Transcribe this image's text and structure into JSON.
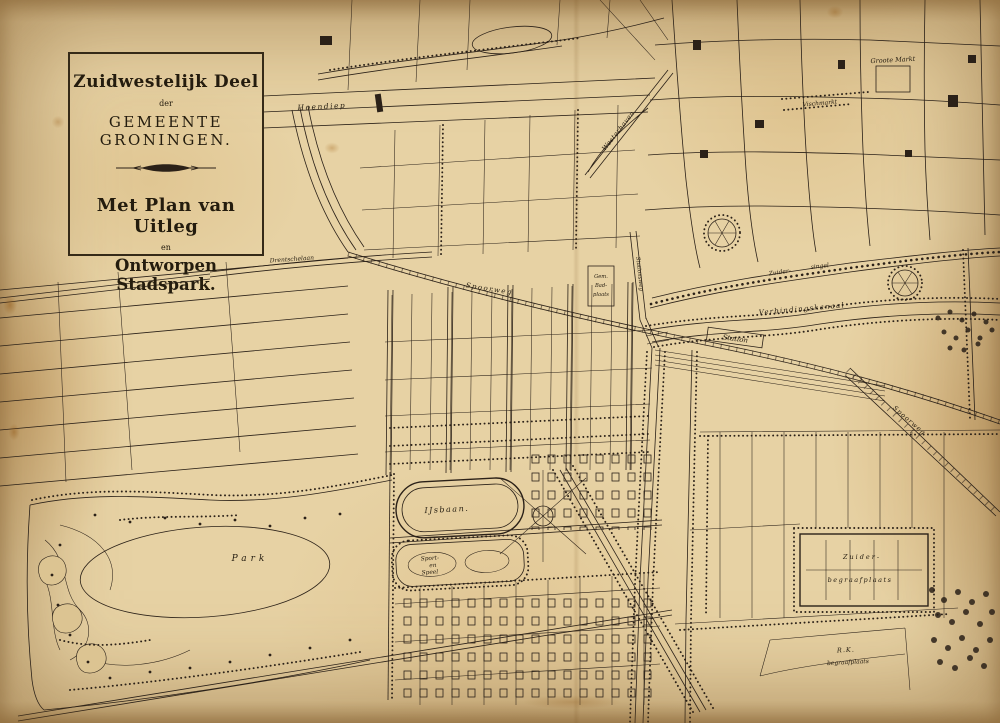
{
  "colors": {
    "paper": "#e8d5aa",
    "ink": "#2b2118"
  },
  "cartouche": {
    "region": "Zuidwestelijk Deel",
    "der": "der",
    "municipality": "GEMEENTE GRONINGEN.",
    "plan_title": "Met Plan van Uitleg",
    "en": "en",
    "park_title": "Ontworpen Stadspark."
  },
  "labels": {
    "hoendiep": "Hoendiep",
    "westerhaven": "Westerhaven",
    "groote_markt": "Groote Markt",
    "vischmarkt": "Vischmarkt",
    "drentschelaan": "Drentschelaan",
    "spoorweg_west": "Spoorweg",
    "spoorweg_oost": "Spoorweg",
    "gem_bad_1": "Gem.",
    "gem_bad_2": "Bad-",
    "gem_bad_3": "plaats",
    "stationsweg": "Stationsweg",
    "zuidersingel_1": "Zuider-",
    "zuidersingel_2": "singel",
    "verbindingskanaal": "Verbindingskanaal",
    "station": "Station",
    "ijsbaan": "IJsbaan.",
    "sport_1": "Sport-",
    "sport_2": "en",
    "sport_3": "Speel",
    "park": "Park",
    "zuider_begraafplaats_1": "Zuider-",
    "zuider_begraafplaats_2": "begraafplaats",
    "rk_1": "R.K.",
    "rk_2": "begraafplaats"
  }
}
